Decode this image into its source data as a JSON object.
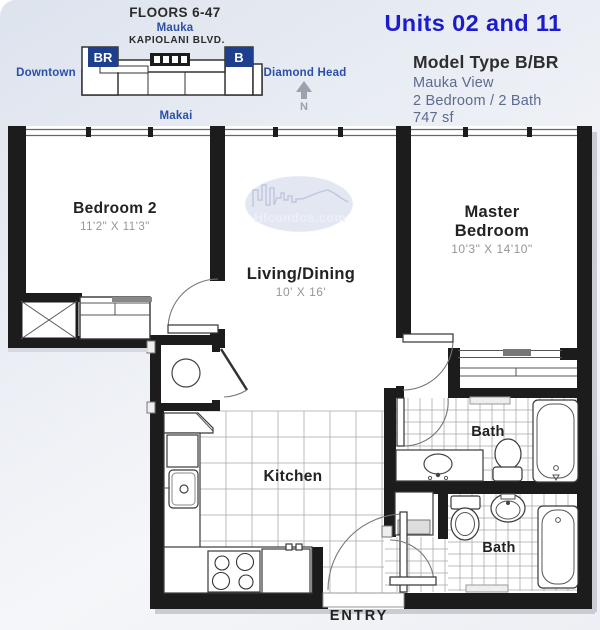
{
  "locator": {
    "floors_label": "FLOORS 6-47",
    "mauka_label": "Mauka",
    "street_label": "KAPIOLANI BLVD.",
    "downtown_label": "Downtown",
    "diamond_head_label": "Diamond Head",
    "makai_label": "Makai",
    "unit_br_label": "BR",
    "unit_b_label": "B",
    "north_label": "N"
  },
  "header": {
    "units_title": "Units 02 and 11",
    "model_type": "Model Type B/BR",
    "view_line": "Mauka View",
    "bed_bath_line": "2 Bedroom / 2 Bath",
    "area_line": "747 sf"
  },
  "watermark": {
    "brand": "HIcondos.com"
  },
  "rooms": {
    "bedroom2": {
      "label": "Bedroom 2",
      "dims": "11'2\" X 11'3\""
    },
    "living": {
      "label": "Living/Dining",
      "dims": "10' X 16'"
    },
    "master": {
      "line1": "Master",
      "line2": "Bedroom",
      "dims": "10'3\" X 14'10\""
    },
    "kitchen": {
      "label": "Kitchen"
    },
    "bath_upper": {
      "label": "Bath"
    },
    "bath_lower": {
      "label": "Bath"
    },
    "entry": {
      "label": "ENTRY"
    }
  },
  "colors": {
    "title_blue": "#1c1ccd",
    "label_blue": "#2b4fa8",
    "slate_text": "#5d6b90",
    "heading_dark": "#2e2e2e",
    "dims_gray": "#979797",
    "wall_black": "#1c1c1c",
    "locator_navy": "#1e3e8e",
    "watermark_lavender": "#ccd3e8"
  }
}
